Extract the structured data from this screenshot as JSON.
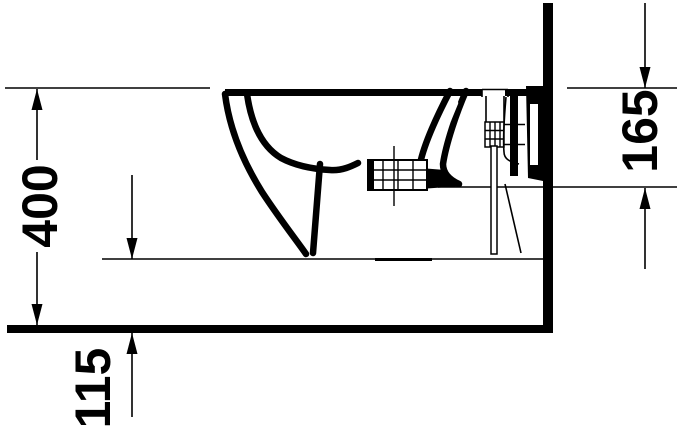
{
  "drawing": {
    "title": "wall-hung bidet side elevation",
    "units": "mm",
    "colors": {
      "line": "#000000",
      "background": "#ffffff"
    },
    "dimensions": {
      "rim_height": {
        "label": "400"
      },
      "drain_offset": {
        "label": "165"
      },
      "underside_clearance": {
        "label": "115"
      }
    }
  }
}
